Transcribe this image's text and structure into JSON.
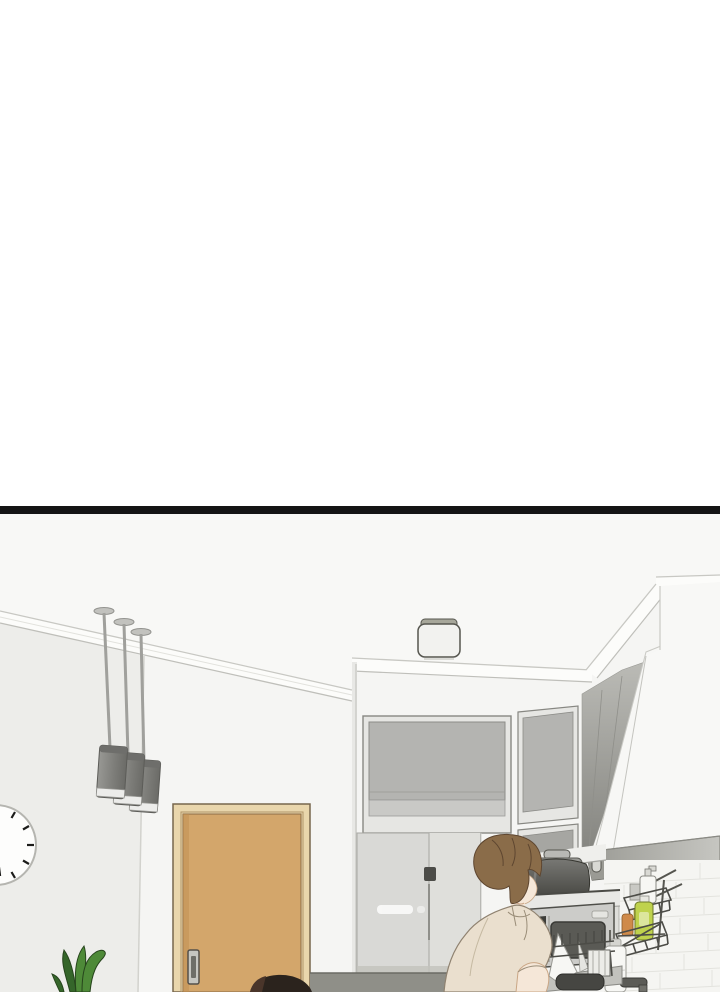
{
  "panel": {
    "kind": "webtoon-comic-panel",
    "divider_color": "#151515",
    "page_background": "#ffffff"
  },
  "objects": [
    "ceiling light",
    "pendant lamps",
    "wall clock",
    "wooden door",
    "potted plant",
    "upper cabinets",
    "refrigerator",
    "range hood",
    "tile backsplash",
    "rice cooker",
    "microwave",
    "shelf unit",
    "dish drying rack",
    "wall wire rack",
    "dish soap bottle",
    "pump bottle",
    "detergent bottle",
    "sink faucet",
    "man at kitchen counter",
    "second person head"
  ],
  "colors": {
    "wall": "#f5f5f3",
    "ceiling": "#f8f8f6",
    "left_wall": "#ededea",
    "clock_face": "#fdfdfc",
    "clock_marks": "#1c1c1a",
    "lamp_band": "#ececea",
    "door_face": "#d3a66b",
    "door_frame": "#e9d6ac",
    "door_handle": "#c6c6c1",
    "panel_gray": "#b4b4b1",
    "panel_frame": "#e6e6e3",
    "fridge_body": "#d9d9d6",
    "fridge_handle": "#4c4c48",
    "floor_band": "#8f8f88",
    "hood_white": "#f8f8f6",
    "hood_band_dark": "#9a9a94",
    "tile": "#f5f5f2",
    "cooker_lid": "#9a9a96",
    "microwave_panel": "#3c3c38",
    "microwave_window": "#5a5a55",
    "rack_wire": "#4c4c47",
    "soap_green": "#bfd24d",
    "scrub_orange": "#cf8a4a",
    "bottle_white": "#f7f7f4",
    "hair_brown": "#8a6c49",
    "skin": "#f5e7d8",
    "shirt_beige": "#eadfce",
    "plant_mid": "#4e8a38",
    "plant_dark": "#35662a",
    "head_dark": "#2b231d"
  }
}
